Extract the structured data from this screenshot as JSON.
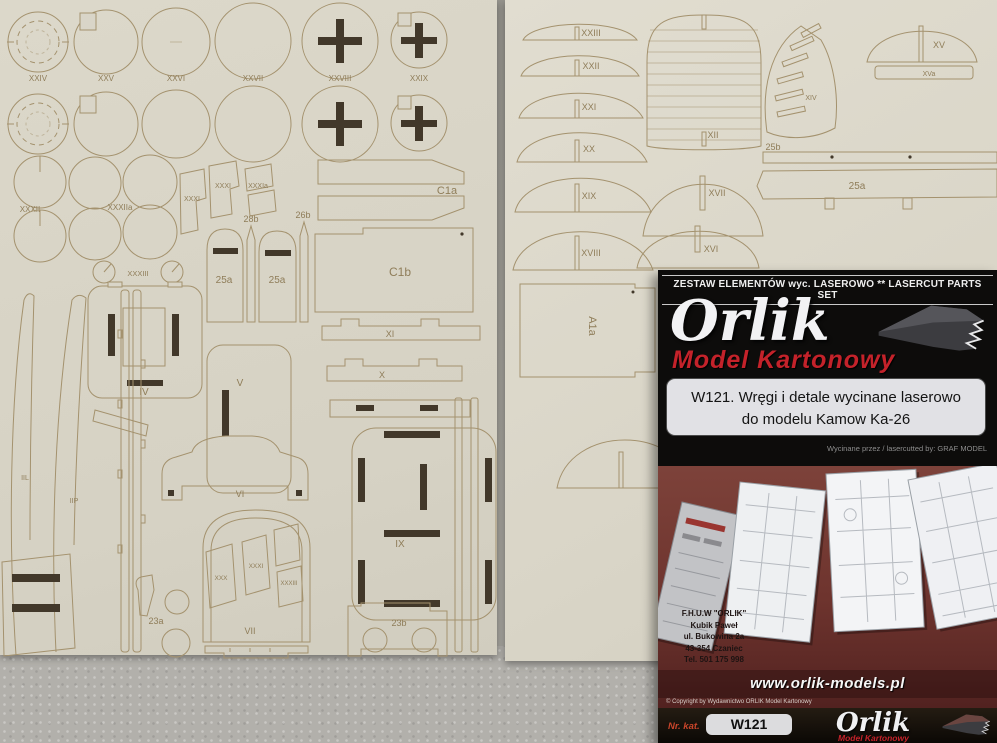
{
  "colors": {
    "sheet": "#d9d5c8",
    "laser_line": "#a4926e",
    "card_red": "#c4222a",
    "card_maroon": "#6e332d"
  },
  "left_sheet": {
    "row1_labels": [
      "XXIV",
      "XXV",
      "XXVI",
      "XXVII",
      "XXVIII",
      "XXIX"
    ],
    "disc_labels": {
      "xxxii": "XXXII",
      "xxxiia": "XXXIIa",
      "xxxiii": "XXXIII"
    },
    "small_parts": {
      "xxxi_a": "XXXI",
      "xxxi_b": "XXXI",
      "xxxia": "XXXIa",
      "p28b": "28b",
      "p26b": "26b",
      "p25a_1": "25a",
      "p25a_2": "25a"
    },
    "strips": {
      "c1a": "C1a",
      "c1b": "C1b",
      "xi": "XI",
      "x": "X"
    },
    "frames": {
      "iv": "IV",
      "v": "V",
      "vi": "VI",
      "vii": "VII",
      "ix": "IX",
      "iil": "IIL",
      "iip": "IIP"
    },
    "inner_parts": {
      "xxx": "XXX",
      "xxxi": "XXXI",
      "xxxiii": "XXXIII"
    },
    "bottom_parts": {
      "p23a": "23a",
      "p23b": "23b"
    }
  },
  "right_sheet": {
    "domes": [
      "XXIII",
      "XXII",
      "XXI",
      "XX",
      "XIX",
      "XVIII"
    ],
    "right_col": {
      "xii": "XII",
      "xvii": "XVII",
      "xvi": "XVI"
    },
    "top_right": {
      "xiv": "XIV",
      "xv": "XV",
      "xva": "XVa",
      "p25b": "25b",
      "p25a": "25a"
    },
    "a1a": "A1a"
  },
  "card": {
    "header": "ZESTAW ELEMENTÓW wyc. LASEROWO  **  LASERCUT PARTS SET",
    "brand": "Orlik",
    "brand_sub": "Model Kartonowy",
    "title_line1": "W121. Wręgi i detale wycinane laserowo",
    "title_line2": "do modelu Kamow Ka-26",
    "credit": "Wycinane przez / lasercutted by: GRAF MODEL",
    "address": [
      "F.H.U.W \"ORLIK\"",
      "Kubik Paweł",
      "ul. Bukowina 2a",
      "43-354 Czaniec",
      "Tel. 501 175 998"
    ],
    "website": "www.orlik-models.pl",
    "copyright": "© Copyright by Wydawnictwo ORLIK Model Kartonowy",
    "catalog_label": "Nr. kat.",
    "catalog_number": "W121",
    "footer_brand": "Orlik",
    "footer_brand_sub": "Model Kartonowy"
  }
}
